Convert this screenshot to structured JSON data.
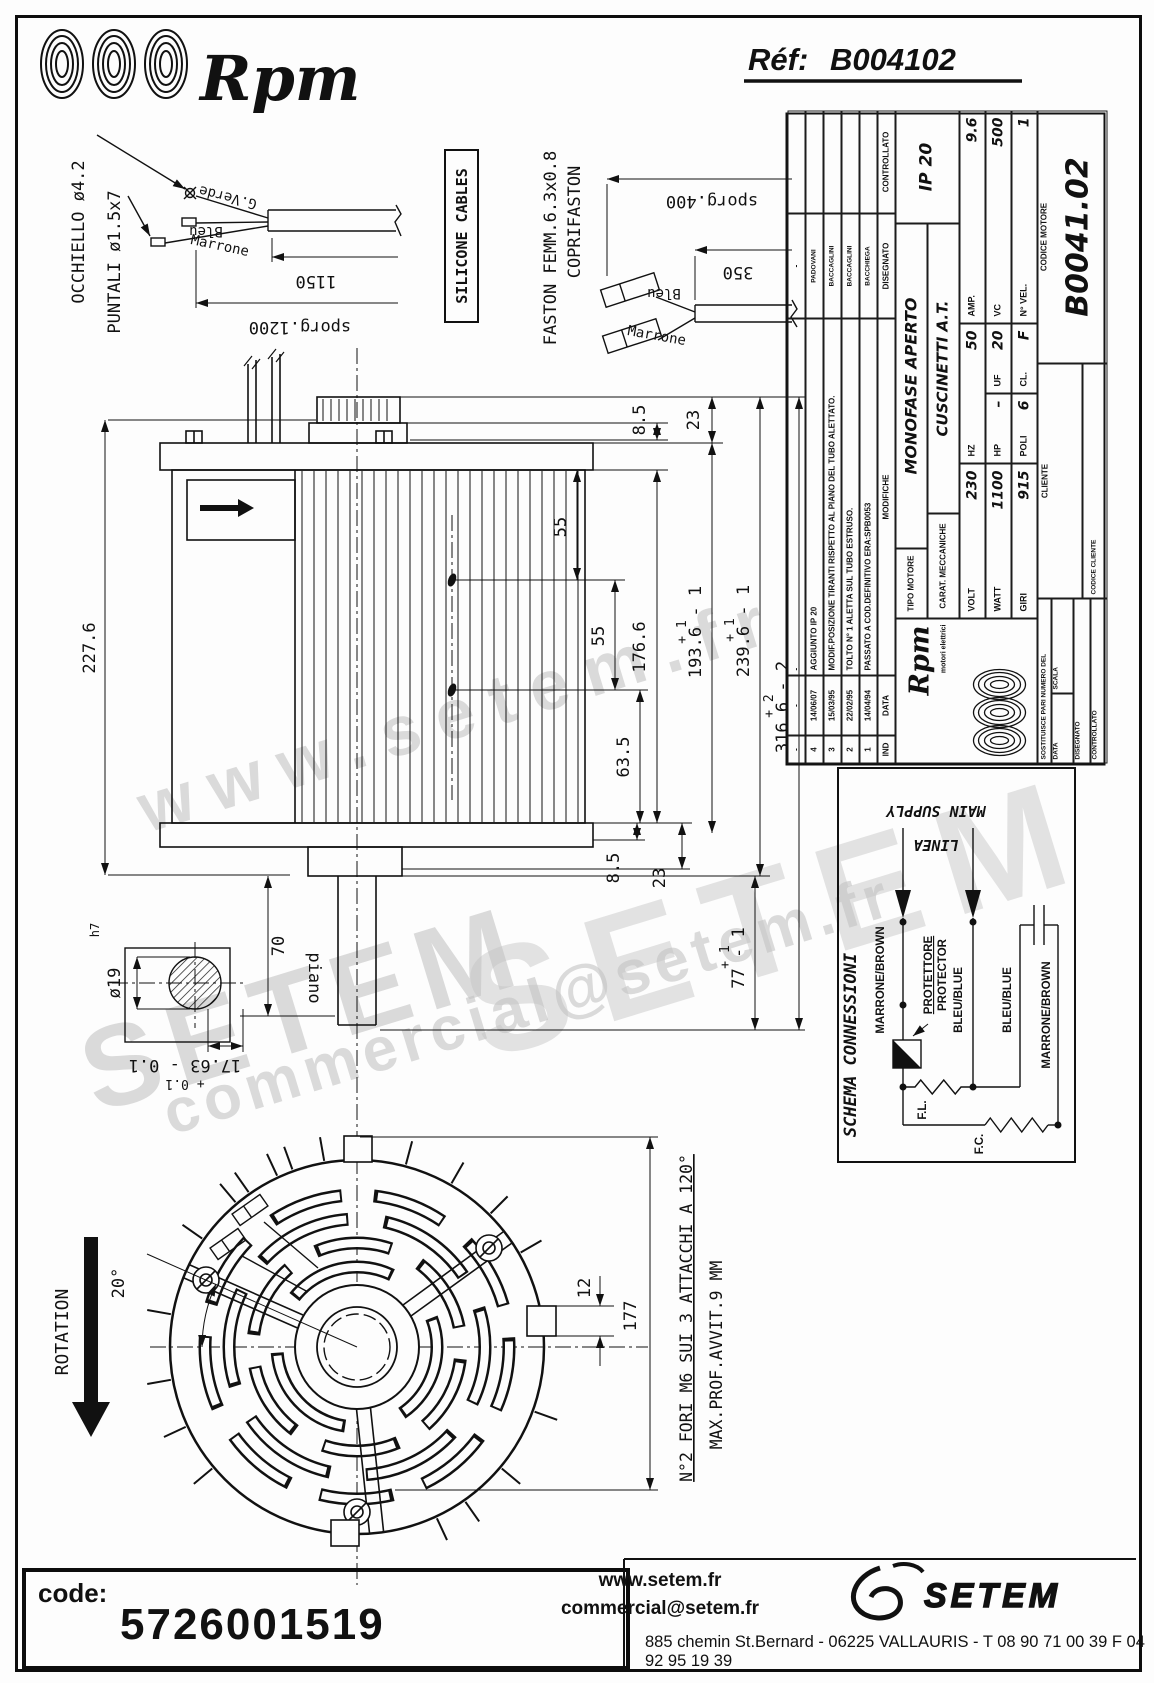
{
  "header": {
    "brand": "Rpm",
    "ref_label": "Réf:",
    "ref_value": "B004102"
  },
  "cable_detail": {
    "occhiello": "OCCHIELLO ø4.2",
    "puntali": "PUNTALI ø1.5x7",
    "gverde": "G.Verde",
    "bleu": "Bleu",
    "marrone": "Marrone",
    "d1150": "1150",
    "sporg": "sporg.1200"
  },
  "silicone_label": "SILICONE CABLES",
  "faston_detail": {
    "line1": "FASTON FEMM.6.3x0.8",
    "line2": "COPRIFASTON",
    "bleu": "Bleu",
    "marrone": "Marrone",
    "d350": "350",
    "sporg": "sporg.400"
  },
  "side_dims": {
    "d227": "227.6",
    "d85_top": "8.5",
    "d23_top": "23",
    "d55_a": "55",
    "d55_b": "55",
    "d63": "63.5",
    "d176": "176.6",
    "d193": "193.6 - 1",
    "d193_tol": "+ 1",
    "d239": "239.6 - 1",
    "d239_tol": "+ 1",
    "d316": "316.6 - 2",
    "d316_tol": "+ 2",
    "d85_bot": "8.5",
    "d23_bot": "23",
    "d77": "77 - 1",
    "d77_tol": "+ 1",
    "d70": "70",
    "piano": "piano",
    "h7": "h7",
    "dia19": "ø19",
    "d1763": "17.63 - 0.1",
    "d1763_tol": "+ 0.1"
  },
  "front": {
    "rotation": "ROTATION",
    "angle": "20°",
    "d12": "12",
    "d177": "177",
    "note_holes": "N°2 FORI M6 SUI 3 ATTACCHI A 120°",
    "note_depth": "MAX.PROF.AVVIT.9 MM"
  },
  "schema": {
    "title": "SCHEMA CONNESSIONI",
    "supply": "MAIN SUPPLY",
    "linea": "LINEA",
    "marrone1": "MARRONE/BROWN",
    "prot1": "PROTETTORE",
    "prot2": "PROTECTOR",
    "bleu1": "BLEU/BLUE",
    "bleu2": "BLEU/BLUE",
    "marrone2": "MARRONE/BROWN",
    "fl": "F.L.",
    "fc": "F.C."
  },
  "tb": {
    "rows": [
      {
        "ind": "-",
        "date": "-",
        "desc": "-",
        "by": "-"
      },
      {
        "ind": "4",
        "date": "14/06/07",
        "desc": "AGGIUNTO IP 20",
        "by": "PADOVANI"
      },
      {
        "ind": "3",
        "date": "15/03/95",
        "desc": "MODIF.POSIZIONE TIRANTI RISPETTO AL PIANO DEL TUBO ALETTATO.",
        "by": "BACCAGLINI"
      },
      {
        "ind": "2",
        "date": "22/02/95",
        "desc": "TOLTO N° 1 ALETTA SUL TUBO ESTRUSO.",
        "by": "BACCAGLINI"
      },
      {
        "ind": "1",
        "date": "14/04/94",
        "desc": "PASSATO A COD.DEFINITIVO ERA:SPB0053",
        "by": "BACCHIEGA"
      }
    ],
    "h_ind": "IND",
    "h_data": "DATA",
    "h_mod": "MODIFICHE",
    "h_dis": "DISEGNATO",
    "h_con": "CONTROLLATO",
    "tipo_label": "TIPO MOTORE",
    "tipo": "MONOFASE APERTO",
    "ip": "IP 20",
    "carat_label": "CARAT. MECCANICHE",
    "carat": "CUSCINETTI A.T.",
    "volt_l": "VOLT",
    "volt": "230",
    "hz_l": "HZ",
    "hz": "50",
    "amp_l": "AMP.",
    "amp": "9.6",
    "watt_l": "WATT",
    "watt": "1100",
    "hp_l": "HP",
    "hp": "–",
    "uf_l": "UF",
    "uf": "20",
    "vc_l": "VC",
    "vc": "500",
    "giri_l": "GIRI",
    "giri": "915",
    "poli_l": "POLI",
    "poli": "6",
    "cl_l": "CL.",
    "cl": "F",
    "nvel_l": "N° VEL.",
    "nvel": "1",
    "brand": "Rpm",
    "brand_sub": "motori elettrici",
    "sost": "SOSTITUISCE PARI NUMERO DEL",
    "data_l": "DATA",
    "scala_l": "SCALA",
    "dis_l": "DISEGNATO",
    "con_l": "CONTROLLATO",
    "cliente_l": "CLIENTE",
    "cod_cli_l": "CODICE CLIENTE",
    "cod_mot_l": "CODICE MOTORE",
    "cod_mot": "B0041.02"
  },
  "watermarks": {
    "web": "www.setem.fr",
    "brand": "SETEM",
    "email": "commercial@setem.fr"
  },
  "footer": {
    "code_label": "code:",
    "code": "5726001519",
    "web": "www.setem.fr",
    "email": "commercial@setem.fr",
    "brand": "SETEM",
    "address": "885 chemin St.Bernard  -  06225 VALLAURIS  -  T 08 90 71 00 39   F 04 92 95 19 39"
  }
}
